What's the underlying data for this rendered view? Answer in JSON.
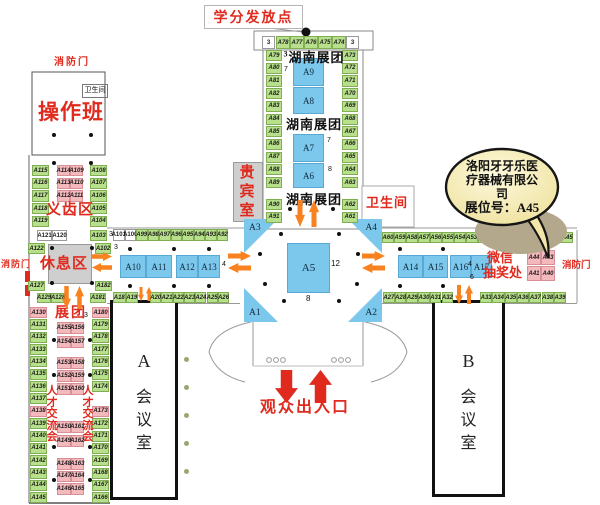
{
  "colors": {
    "green": "#b8e08c",
    "pink": "#f4b9bd",
    "blue": "#7cc7ec",
    "orange": "#f8821f",
    "red": "#e02a1e",
    "gray": "#cfcfcf",
    "bubble_fill": "#f7eeb7"
  },
  "labels": {
    "credit_point": "学分发放点",
    "fire_door_top": "消防门",
    "fire_door_left": "消防门",
    "fire_door_right": "消防门",
    "restroom_small": "卫生间",
    "restroom_right": "卫生间",
    "operation_class": "操作班",
    "denture_area": "义齿区",
    "rest_area": "休息区",
    "vip_room": "贵宾室",
    "hunan_group": "湖南展团",
    "exhibition_group": "展团",
    "job_fair": "人才交流会",
    "wechat_line1": "微信",
    "wechat_line2": "抽奖处",
    "entrance": "观众出入口",
    "meeting_a": "A",
    "meeting_b": "B",
    "meeting_room": "会议室"
  },
  "bubble": {
    "line1": "洛阳牙牙乐医",
    "line2": "疗器械有限公",
    "line3": "司",
    "line4": "展位号：A45"
  },
  "numbers": {
    "hall_top_left": "3",
    "hall_top_right": "3",
    "hunan_sup": "3",
    "a9_side": "7",
    "a7_side": "7",
    "a6_side": "8",
    "a5_right": "12",
    "a5_bottom": "8",
    "a103_side": "3",
    "a102_side": "3",
    "west_blue": "4",
    "east_blue": "4",
    "east_blue2": "6",
    "zhantuan": "3"
  },
  "booths": {
    "hall_top": [
      "A78",
      "A77",
      "A76",
      "A75",
      "A74"
    ],
    "hall_left": [
      "A79",
      "A80",
      "A81",
      "A82",
      "A83",
      "A84",
      "A85",
      "A86",
      "A87",
      "A88",
      "A89"
    ],
    "hall_right": [
      "A73",
      "A72",
      "A71",
      "A70",
      "A69",
      "A68",
      "A67",
      "A66",
      "A65",
      "A64",
      "A63"
    ],
    "hall_left2": [
      "A90",
      "A91"
    ],
    "hall_right2": [
      "A62",
      "A61"
    ],
    "hall_center": [
      "A9",
      "A8",
      "A7",
      "A6"
    ],
    "cross": [
      "A3",
      "A4",
      "A1",
      "A2"
    ],
    "a5": "A5",
    "ul_left": [
      "A115",
      "A116",
      "A117",
      "A118",
      "A119"
    ],
    "ul_right": [
      "A108",
      "A107",
      "A106",
      "A105",
      "A104"
    ],
    "ul_pink": [
      "A114",
      "A109",
      "A113",
      "A110",
      "A112",
      "A111"
    ],
    "row_a121": [
      "A121",
      "A120"
    ],
    "row_a129": [
      "A129",
      "A128"
    ],
    "a103": "A103",
    "a102": "A102",
    "a122": "A122",
    "a127": "A127",
    "a182": "A182",
    "a181": "A181",
    "corridor_nw": [
      "A101",
      "A100",
      "A99",
      "A98",
      "A97",
      "A96",
      "A95",
      "A94",
      "A93",
      "A92"
    ],
    "corridor_sw1": [
      "A18",
      "A19"
    ],
    "corridor_sw2": [
      "A20",
      "A21",
      "A22",
      "A23",
      "A24",
      "A25",
      "A26"
    ],
    "blue_w1": [
      "A10",
      "A11"
    ],
    "blue_w2": [
      "A12",
      "A13"
    ],
    "corridor_ne": [
      "A60",
      "A59",
      "A58",
      "A57",
      "A56",
      "A55",
      "A54",
      "A53",
      "A52",
      "A51",
      "A50",
      "A49",
      "A48",
      "A47",
      "A46",
      "A45"
    ],
    "corridor_se1": [
      "A27",
      "A28",
      "A29",
      "A30",
      "A31",
      "A32"
    ],
    "corridor_se2": [
      "A33",
      "A34",
      "A35",
      "A36",
      "A37",
      "A38",
      "A39"
    ],
    "blue_e1": [
      "A14",
      "A15"
    ],
    "blue_e2": [
      "A16",
      "A17"
    ],
    "wechat_block": [
      "A44",
      "A43",
      "A41",
      "A40"
    ],
    "bl_left": [
      "A130",
      "A131",
      "A132",
      "A133",
      "A134",
      "A135",
      "A136",
      "A137",
      "A138",
      "A139",
      "A140",
      "A141",
      "A142",
      "A143",
      "A144",
      "A145"
    ],
    "bl_right_upper": [
      "A180",
      "A179",
      "A178",
      "A177",
      "A176",
      "A175",
      "A174"
    ],
    "bl_right_lower": [
      "A173",
      "A172",
      "A171",
      "A170",
      "A169",
      "A168",
      "A167",
      "A166"
    ],
    "bl_pink1": [
      "A155",
      "A156",
      "A154",
      "A157"
    ],
    "bl_pink2": [
      "A153",
      "A158",
      "A152",
      "A159",
      "A151",
      "A160"
    ],
    "bl_pink3": [
      "A150",
      "A161",
      "A149",
      "A162"
    ],
    "bl_pink4": [
      "A148",
      "A163",
      "A147",
      "A164",
      "A146",
      "A165"
    ]
  }
}
